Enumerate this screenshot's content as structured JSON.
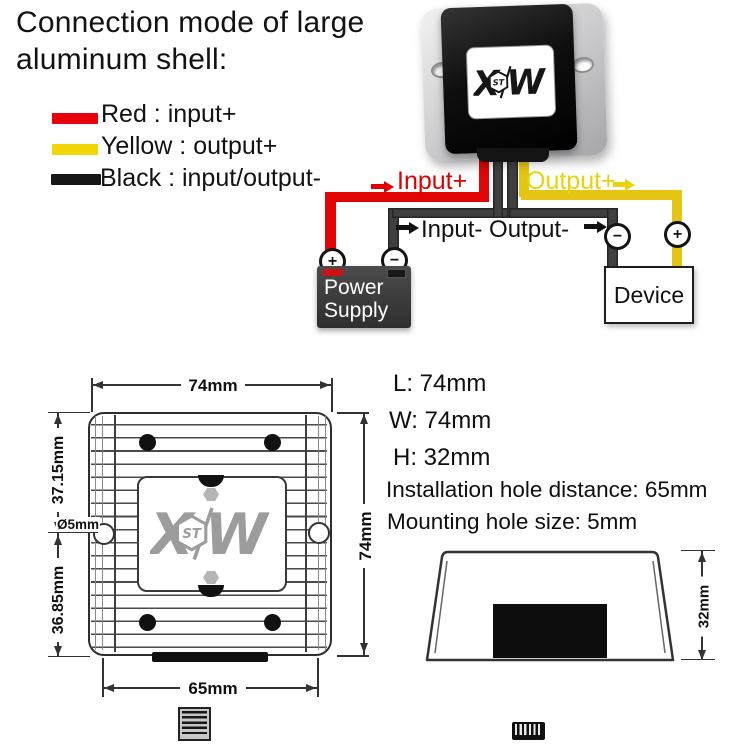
{
  "title": {
    "line1": "Connection mode of large",
    "line2": "aluminum shell:"
  },
  "legend": {
    "items": [
      {
        "name": "red",
        "color": "#e8000d",
        "label": "Red : input+"
      },
      {
        "name": "yellow",
        "color": "#f2d506",
        "label": "Yellow : output+"
      },
      {
        "name": "black",
        "color": "#161616",
        "label": "Black : input/output-"
      }
    ]
  },
  "wiring": {
    "input_plus": "Input+",
    "output_plus": "Output+",
    "inout_minus": "Input- Output-",
    "plus_sign": "+",
    "minus_sign": "−",
    "power_supply": {
      "line1": "Power",
      "line2": "Supply"
    },
    "device": "Device",
    "wire_colors": {
      "input_plus": "#e10505",
      "output_plus": "#e6c414",
      "negative": "#3f3f3f"
    }
  },
  "logo": {
    "x": "X",
    "st": "ST",
    "w": "W"
  },
  "specs": {
    "l": "L: 74mm",
    "w": "W: 74mm",
    "h": "H: 32mm",
    "hole_distance": "Installation hole distance: 65mm",
    "hole_size": "Mounting hole size: 5mm"
  },
  "dims": {
    "top_width": "74mm",
    "right_height": "74mm",
    "bottom_holes": "65mm",
    "upper": "37.15mm",
    "lower": "36.85mm",
    "hole_dia": "Ø5mm",
    "side_height": "32mm"
  }
}
